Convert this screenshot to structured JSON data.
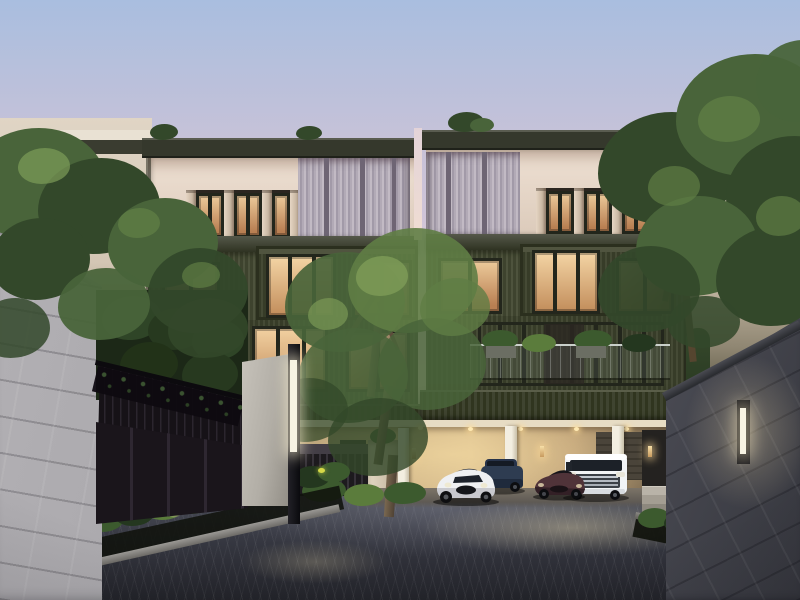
{
  "scene": {
    "type": "architectural-render",
    "time_of_day": "dusk",
    "description": "Modern luxury four-storey townhome complex at dusk with gated stone-wall entry, paved driveway, ground-floor parking with four cars, garden beds with yellow flowers, and large trees"
  },
  "colors": {
    "sky_top": "#a9bedf",
    "sky_mid": "#cfc4d8",
    "sky_low": "#eed9d6",
    "sky_horizon": "#f4e2d0",
    "fascia_dark": "#35382c",
    "fascia_edge": "#5a5c50",
    "cream": "#e6dacb",
    "cream_shadow": "#cfc0ae",
    "corrugated_light": "#b6aeb8",
    "corrugated_deep": "#6e6574",
    "olive": "#474c38",
    "olive_dark": "#30351f",
    "olive_deep": "#262a1b",
    "olive_light": "#5a5f48",
    "window_warm": "#f0d0a0",
    "window_amber": "#b97f52",
    "frame_dark": "#23261c",
    "garage_glow": "#e8d4a4",
    "garage_mid": "#c3a878",
    "garage_shadow": "#75634b",
    "column_white": "#ece5d8",
    "stone_left": "#a8a6aa",
    "stone_left_dark": "#7c7a80",
    "stone_right": "#6b6d76",
    "stone_right_dark": "#35363d",
    "coping": "#282a2e",
    "gate_metal": "#161217",
    "gate_seam": "#2e2731",
    "gate_green": "#2f4527",
    "pillar_light": "#c6c2ba",
    "pillar_shade": "#918d85",
    "lamp_black": "#141418",
    "lamp_glow": "#f7f3e3",
    "pavement_light": "#565965",
    "pavement": "#3a3c46",
    "pavement_dark": "#222329",
    "curb": "#9b9995",
    "plant_dark": "#24371f",
    "plant_mid": "#3c5a2e",
    "plant_light": "#5b7c3c",
    "flower": "#d6d848",
    "tree_dark": "#33482a",
    "tree_mid": "#49643a",
    "tree_light": "#5f7d45",
    "tree_hi": "#7e9c58",
    "trunk": "#6b583f",
    "car_white": "#eff0f2",
    "car_blue": "#2e3c51",
    "car_red": "#503339",
    "car_van": "#f2f4f6"
  },
  "objects": {
    "sky": {
      "label": "dusk sky"
    },
    "neighbor_left": {
      "label": "adjacent townhome (left)"
    },
    "neighbor_right": {
      "label": "adjacent townhome (right)"
    },
    "townhouse_left": {
      "label": "townhouse block A"
    },
    "townhouse_right": {
      "label": "townhouse block B"
    },
    "parking": {
      "label": "ground-floor parking garage"
    },
    "cars": [
      {
        "label": "white sports coupe"
      },
      {
        "label": "dark blue SUV"
      },
      {
        "label": "maroon sports car"
      },
      {
        "label": "white luxury van"
      }
    ],
    "gate": {
      "label": "dark metal entry gate"
    },
    "pillar": {
      "label": "stone gate pillar"
    },
    "lamp_post": {
      "label": "entrance lamp post"
    },
    "wall_left": {
      "label": "stone perimeter wall (left)"
    },
    "wall_right": {
      "label": "stone perimeter wall (right)"
    },
    "wall_lamp": {
      "label": "wall light"
    },
    "tree_left": {
      "label": "tree over left wall"
    },
    "tree_center": {
      "label": "courtyard tree"
    },
    "tree_right": {
      "label": "large tree (right)"
    },
    "garden_left": {
      "label": "flower bed with yellow blooms (left)"
    },
    "garden_right": {
      "label": "planting bed (right)"
    },
    "driveway": {
      "label": "dark paved driveway"
    }
  }
}
